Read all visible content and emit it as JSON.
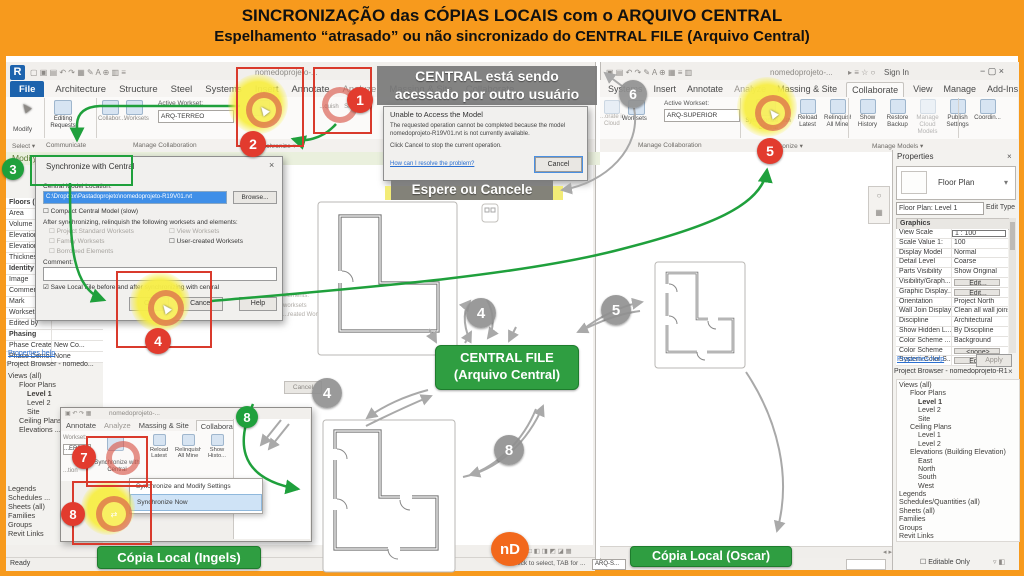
{
  "banner": {
    "line1": "SINCRONIZAÇÃO das CÓPIAS LOCAIS com o ARQUIVO CENTRAL",
    "line2": "Espelhamento “atrasado” ou não sincronizado do CENTRAL FILE (Arquivo Central)"
  },
  "icons": {
    "revit": "R",
    "min": "−",
    "max": "▢",
    "close": "×",
    "dd": "▾"
  },
  "lw": {
    "qat": "▢ ▣ ▤ ↶ ↷ ▦ ✎ A ⊕ ▥ ≡",
    "title": "nomedoprojeto-...",
    "tabs": [
      "File",
      "Architecture",
      "Structure",
      "Steel",
      "Systems",
      "Insert",
      "Annotate",
      "Analyze",
      "Massing & Site",
      "Collaborate"
    ],
    "modify": "Modify",
    "editing": "Editing Requests",
    "collab": "Collabor...",
    "worksets": "Worksets",
    "awl": "Active Workset:",
    "awv": "ARQ-TERREO",
    "fr1": "...quish",
    "fr2": "Sho...",
    "g1": "Select ▾",
    "g2": "Communicate",
    "g3": "Manage Collaboration",
    "g4": "Synchronize ▾",
    "modbar": "Modify | Floors",
    "props": [
      {
        "label": "Floors (1)",
        "bold": true
      },
      {
        "label": "Area",
        "value": ""
      },
      {
        "label": "Volume",
        "value": ""
      },
      {
        "label": "Elevation ...",
        "value": ""
      },
      {
        "label": "Elevation ...",
        "value": ""
      },
      {
        "label": "Thickness",
        "value": ""
      },
      {
        "label": "Identity Data",
        "bold": true
      },
      {
        "label": "Image",
        "value": ""
      },
      {
        "label": "Comments",
        "value": ""
      },
      {
        "label": "Mark",
        "value": ""
      },
      {
        "label": "Workset",
        "value": ""
      },
      {
        "label": "Edited by",
        "value": ""
      },
      {
        "label": "Phasing",
        "bold": true
      },
      {
        "label": "Phase Created",
        "value": "New Co..."
      },
      {
        "label": "Phase Demoli...",
        "value": "None"
      }
    ],
    "help": "Properties help",
    "btitle": "Project Browser - nomedo...",
    "tree1": [
      {
        "label": "Views (all)",
        "indent": 0
      },
      {
        "label": "Floor Plans",
        "indent": 1
      },
      {
        "label": "Level 1",
        "indent": 2,
        "bold": true
      },
      {
        "label": "Level 2",
        "indent": 2
      },
      {
        "label": "Site",
        "indent": 2
      },
      {
        "label": "Ceiling Plans",
        "indent": 1
      },
      {
        "label": "Elevations ...",
        "indent": 1
      }
    ],
    "tree2": [
      {
        "label": "Legends",
        "indent": 0
      },
      {
        "label": "Schedules ...",
        "indent": 0
      },
      {
        "label": "Sheets (all)",
        "indent": 0
      },
      {
        "label": "Families",
        "indent": 0
      },
      {
        "label": "Groups",
        "indent": 0
      },
      {
        "label": "Revit Links",
        "indent": 0
      }
    ],
    "ready": "Ready"
  },
  "sync": {
    "title": "Synchronize with Central",
    "close": "×",
    "loc": "Central Model Location:",
    "path": "C:\\Dropbox\\Pastadoprojeto\\nomedoprojeto-R19V01.rvt",
    "browse": "Browse...",
    "compact": "Compact Central Model (slow)",
    "after": "After synchronizing, relinquish the following worksets and elements:",
    "cbl": [
      "Project Standard Worksets",
      "Family Worksets",
      "Borrowed Elements"
    ],
    "cbr": [
      "View Worksets",
      "User-created Worksets"
    ],
    "comment": "Comment:",
    "save": "Save Local File before and after synchronizing with central",
    "ok": "OK",
    "cancel": "Cancel",
    "help": "Help"
  },
  "ghost": {
    "e1": "elements:",
    "e2": "worksets",
    "e3": "...reated Work...",
    "cancel": "Cancel"
  },
  "un": {
    "title": "Unable to Access the Model",
    "b1": "The requested operation cannot be completed because the model",
    "b2": "nomedoprojeto-R19V01.rvt is not currently available.",
    "b3": "Click Cancel to stop the current operation.",
    "link": "How can I resolve the problem?",
    "cancel": "Cancel"
  },
  "ov": {
    "t1": "CENTRAL está sendo",
    "t2": "acessado por outro usuário",
    "wait": "Espere ou Cancele",
    "cf1": "CENTRAL FILE",
    "cf2": "(Arquivo Central)",
    "ingels": "Cópia Local (Ingels)",
    "oscar": "Cópia Local (Oscar)",
    "n1": "1",
    "n2": "2",
    "n3": "3",
    "n4": "4",
    "n5": "5",
    "n6": "6",
    "n7": "7",
    "n8": "8",
    "logo": "nD"
  },
  "rw": {
    "qat": "▣ ▤ ↶ ↷ ✎ A ⊕ ▦ ≡ ▥",
    "title": "nomedoprojeto-...",
    "ticons": "▸ ≡ ☆ ○",
    "signin": "Sign In",
    "winbtns": "−  ▢  ×",
    "tabs": [
      "Systems",
      "Insert",
      "Annotate",
      "Analyze",
      "Massing & Site",
      "Collaborate",
      "View",
      "Manage",
      "Add-Ins"
    ],
    "cloud1": "...orate in",
    "cloud2": "Cloud",
    "worksets": "Worksets",
    "awl": "Active Workset:",
    "awv": "ARQ-SUPERIOR",
    "syncbtn": "Synchronize with Central",
    "btns": [
      "Reload Latest",
      "Relinquish All Mine",
      "Show History",
      "Restore Backup",
      "Manage Cloud Models",
      "Publish Settings",
      "Coordin..."
    ],
    "g1": "Manage Collaboration",
    "g2": "Synchronize ▾",
    "g3": "Manage Models ▾",
    "ptitle": "Properties",
    "pclose": "×",
    "type": "Floor Plan",
    "sel": "Floor Plan: Level 1",
    "edittype": "Edit Type",
    "graphics": "Graphics",
    "grows": [
      {
        "label": "View Scale",
        "value": "1 : 100",
        "boxed": true
      },
      {
        "label": "Scale Value   1:",
        "value": "100"
      },
      {
        "label": "Display Model",
        "value": "Normal"
      },
      {
        "label": "Detail Level",
        "value": "Coarse"
      },
      {
        "label": "Parts Visibility",
        "value": "Show Original"
      },
      {
        "label": "Visibility/Graph...",
        "value": "Edit...",
        "btn": true
      },
      {
        "label": "Graphic Display...",
        "value": "Edit...",
        "btn": true
      },
      {
        "label": "Orientation",
        "value": "Project North"
      },
      {
        "label": "Wall Join Display",
        "value": "Clean all wall joins"
      },
      {
        "label": "Discipline",
        "value": "Architectural"
      },
      {
        "label": "Show Hidden L...",
        "value": "By Discipline"
      },
      {
        "label": "Color Scheme ...",
        "value": "Background"
      },
      {
        "label": "Color Scheme",
        "value": "<none>",
        "btn": true
      },
      {
        "label": "System Color S...",
        "value": "Edit...",
        "btn": true
      }
    ],
    "help": "Properties help",
    "apply": "Apply",
    "btitle": "Project Browser - nomedoprojeto-R19...",
    "bclose": "×",
    "tree": [
      {
        "label": "Views (all)",
        "indent": 0
      },
      {
        "label": "Floor Plans",
        "indent": 1
      },
      {
        "label": "Level 1",
        "indent": 2,
        "bold": true
      },
      {
        "label": "Level 2",
        "indent": 2
      },
      {
        "label": "Site",
        "indent": 2
      },
      {
        "label": "Ceiling Plans",
        "indent": 1
      },
      {
        "label": "Level 1",
        "indent": 2
      },
      {
        "label": "Level 2",
        "indent": 2
      },
      {
        "label": "Elevations (Building Elevation)",
        "indent": 1
      },
      {
        "label": "East",
        "indent": 2
      },
      {
        "label": "North",
        "indent": 2
      },
      {
        "label": "South",
        "indent": 2
      },
      {
        "label": "West",
        "indent": 2
      },
      {
        "label": "Legends",
        "indent": 0
      },
      {
        "label": "Schedules/Quantities (all)",
        "indent": 0
      },
      {
        "label": "Sheets (all)",
        "indent": 0
      },
      {
        "label": "Families",
        "indent": 0
      },
      {
        "label": "Groups",
        "indent": 0
      },
      {
        "label": "Revit Links",
        "indent": 0
      }
    ],
    "editable": "Editable Only"
  },
  "mini": {
    "title": "nomedoprojeto-...",
    "qat": "▣ ↶ ↷ ▦",
    "tabs": [
      "Annotate",
      "Analyze",
      "Massing & Site",
      "Collaborate"
    ],
    "sync": "Synchronize with Central",
    "btns": [
      "Reload Latest",
      "Relinquish All Mine",
      "Show Histo..."
    ],
    "m1": "Synchronize and Modify Settings",
    "m2": "Synchronize Now",
    "wl": "Workset:",
    "wv": "...ERREO",
    "fr": "...tion"
  },
  "status": {
    "scale": "1 : 100",
    "vicons": "□ ◧ ◨ ◩ ◪ ▦",
    "hint": "Click to select, TAB for ...",
    "ws": "ARQ-S..."
  },
  "plans": {
    "p1": [
      "2"
    ],
    "p2": [
      "3",
      "2",
      "4",
      "5"
    ],
    "p3": [
      "3",
      "2",
      "4",
      "5"
    ]
  }
}
